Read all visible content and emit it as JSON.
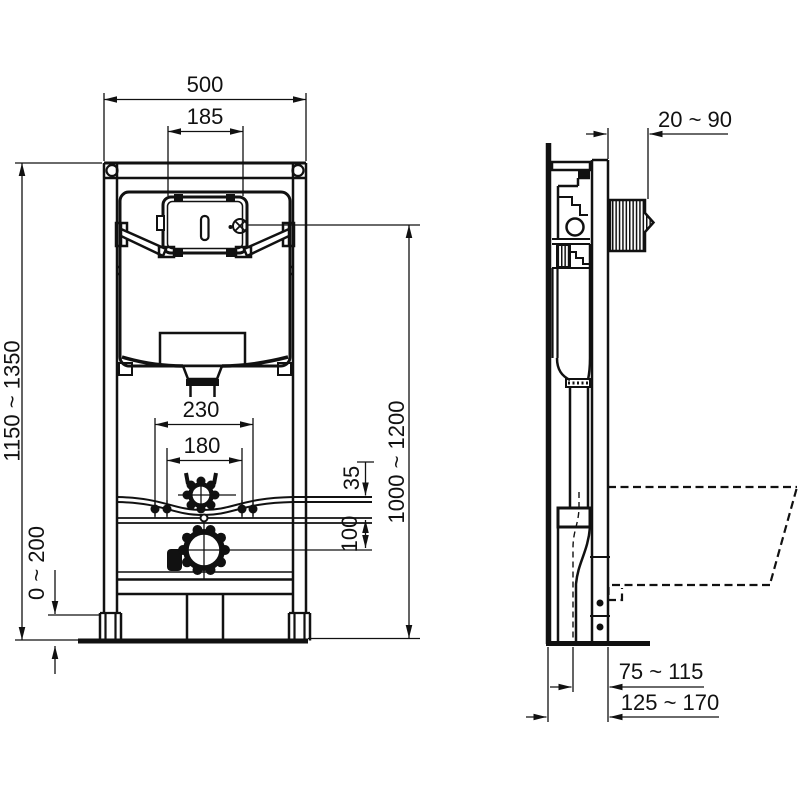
{
  "drawing": {
    "type": "installation technical drawing, in-wall WC frame, front and side views",
    "views": {
      "front": "front view of mounting frame with cistern",
      "side": "side section view with wall, flush plate depth and WC pan outline"
    }
  },
  "colors": {
    "line": "#111111",
    "background": "#ffffff"
  },
  "dims": {
    "frame_width": "500",
    "opening_width": "185",
    "height_range": "1150 ~ 1350",
    "foot_range": "0 ~ 200",
    "bolt_outer": "230",
    "bolt_inner": "180",
    "inlet_offset": "35",
    "outlet_offset": "100",
    "actuation_height": "1000 ~ 1200",
    "plate_depth": "20 ~ 90",
    "outlet_dist_near": "75 ~ 115",
    "outlet_dist_far": "125 ~ 170"
  }
}
